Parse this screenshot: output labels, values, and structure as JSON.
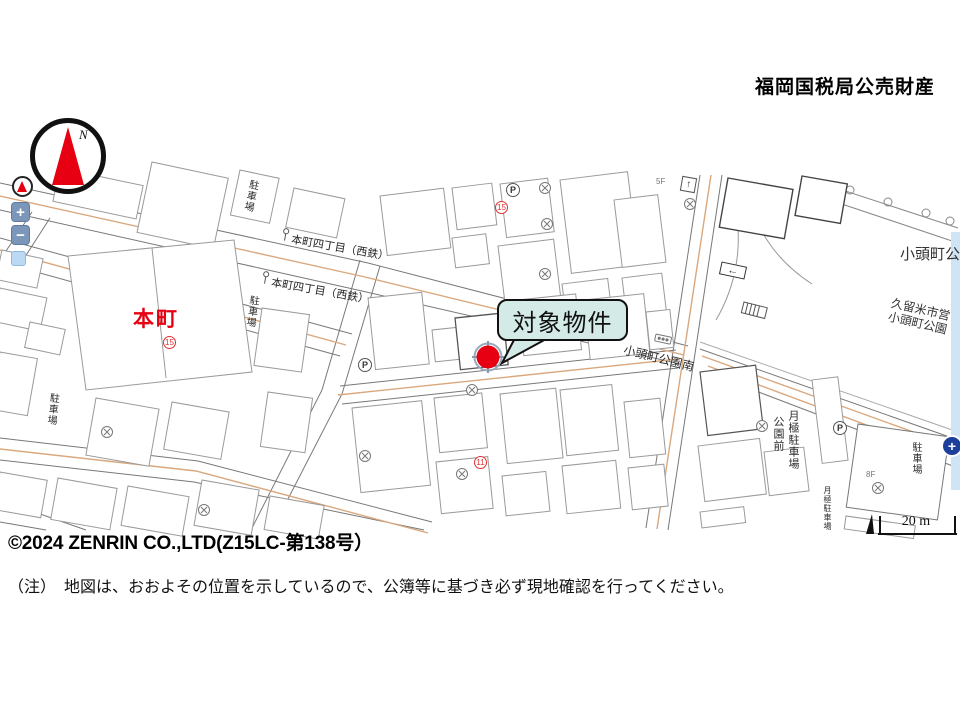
{
  "header": {
    "title": "福岡国税局公売財産"
  },
  "compass": {
    "label": "N"
  },
  "map_controls": {
    "zoom_in": "+",
    "zoom_out": "−",
    "pan": "+"
  },
  "map": {
    "callout": {
      "label": "対象物件"
    },
    "scale_label": "20 m",
    "labels": {
      "district": "本町",
      "bus_stop_1": "本町四丁目（西鉄）",
      "bus_stop_2": "本町四丁目（西鉄）",
      "intersection": "小頭町公園南",
      "park_name": "小頭町公",
      "park_sub_1": "久留米市営",
      "park_sub_2": "小頭町公園",
      "monthly_parking_front": "公園前",
      "monthly_parking_main": "月極駐車場",
      "monthly_parking_small": "月極駐車場"
    },
    "parking_labels": [
      "駐車場",
      "駐車場",
      "駐車場",
      "駐車場"
    ],
    "p_badges": [
      "P",
      "P",
      "P"
    ],
    "red_badges": [
      "15",
      "15",
      "11"
    ],
    "micro_labels": [
      "5F",
      "8F"
    ],
    "sign_arrows": {
      "up": "↑",
      "left": "←"
    },
    "colors": {
      "road_accent": "#d9a87e",
      "marker": "#e60012",
      "callout_bg": "#d3eae6",
      "district_red": "#e60012"
    }
  },
  "footer": {
    "copyright": "©2024 ZENRIN CO.,LTD(Z15LC-第138号）",
    "note": "（注）　地図は、おおよその位置を示しているので、公簿等に基づき必ず現地確認を行ってください。"
  }
}
